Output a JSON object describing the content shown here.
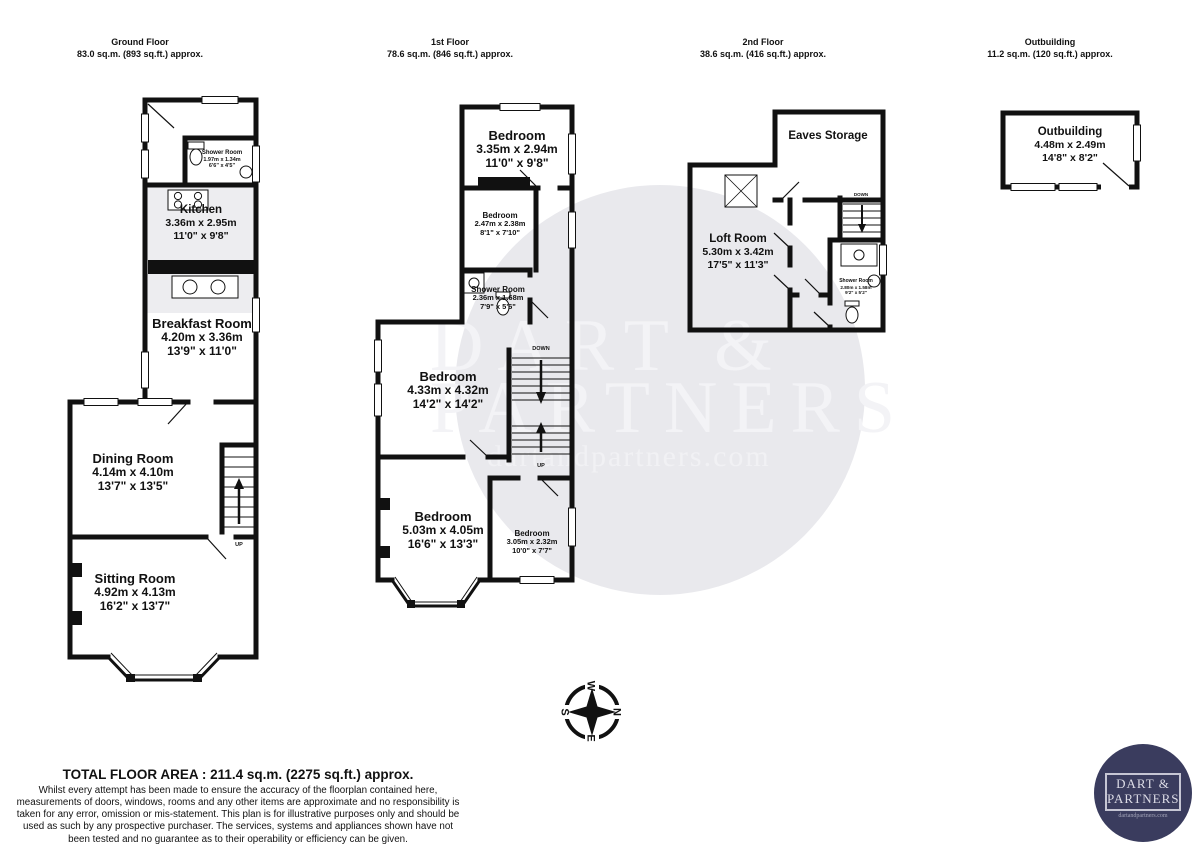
{
  "floors": [
    {
      "title": "Ground Floor",
      "area": "83.0 sq.m. (893 sq.ft.) approx.",
      "rooms": [
        {
          "name": "Shower Room",
          "metric": "1.97m  x 1.34m",
          "imperial": "6'6\"  x 4'5\""
        },
        {
          "name": "Kitchen",
          "metric": "3.36m  x 2.95m",
          "imperial": "11'0\"  x 9'8\""
        },
        {
          "name": "Breakfast Room",
          "metric": "4.20m  x 3.36m",
          "imperial": "13'9\"  x 11'0\""
        },
        {
          "name": "Dining Room",
          "metric": "4.14m  x 4.10m",
          "imperial": "13'7\"  x 13'5\""
        },
        {
          "name": "Sitting Room",
          "metric": "4.92m  x 4.13m",
          "imperial": "16'2\"  x 13'7\""
        }
      ],
      "stairs": [
        {
          "label": "UP"
        }
      ]
    },
    {
      "title": "1st Floor",
      "area": "78.6 sq.m. (846 sq.ft.) approx.",
      "rooms": [
        {
          "name": "Bedroom",
          "metric": "3.35m  x 2.94m",
          "imperial": "11'0\"  x 9'8\""
        },
        {
          "name": "Bedroom",
          "metric": "2.47m  x 2.38m",
          "imperial": "8'1\"  x 7'10\""
        },
        {
          "name": "Shower Room",
          "metric": "2.36m  x 1.68m",
          "imperial": "7'9\"  x 5'6\""
        },
        {
          "name": "Bedroom",
          "metric": "4.33m  x 4.32m",
          "imperial": "14'2\"  x 14'2\""
        },
        {
          "name": "Bedroom",
          "metric": "5.03m  x 4.05m",
          "imperial": "16'6\"  x 13'3\""
        },
        {
          "name": "Bedroom",
          "metric": "3.05m  x 2.32m",
          "imperial": "10'0\"  x 7'7\""
        }
      ],
      "stairs": [
        {
          "label": "DOWN"
        },
        {
          "label": "UP"
        }
      ]
    },
    {
      "title": "2nd Floor",
      "area": "38.6 sq.m. (416 sq.ft.) approx.",
      "rooms": [
        {
          "name": "Eaves Storage",
          "metric": "",
          "imperial": ""
        },
        {
          "name": "Loft Room",
          "metric": "5.30m  x 3.42m",
          "imperial": "17'5\"  x 11'3\""
        },
        {
          "name": "Shower Room",
          "metric": "2.80m  x 1.58m",
          "imperial": "9'2\"  x 5'2\""
        }
      ],
      "stairs": [
        {
          "label": "DOWN"
        }
      ]
    },
    {
      "title": "Outbuilding",
      "area": "11.2 sq.m. (120 sq.ft.) approx.",
      "rooms": [
        {
          "name": "Outbuilding",
          "metric": "4.48m  x 2.49m",
          "imperial": "14'8\"  x 8'2\""
        }
      ],
      "stairs": []
    }
  ],
  "watermark": {
    "line1": "DART &",
    "line2": "PARTNERS",
    "url": "dartandpartners.com"
  },
  "compass": {
    "n": "N",
    "e": "E",
    "s": "S",
    "w": "W"
  },
  "footer": {
    "total": "TOTAL FLOOR AREA : 211.4 sq.m. (2275 sq.ft.) approx.",
    "disclaimer": "Whilst every attempt has been made to ensure the accuracy of the floorplan contained here, measurements of doors, windows, rooms and any other items are approximate and no responsibility is taken for any error, omission or mis-statement. This plan is for illustrative purposes only and should be used as such by any prospective purchaser. The services, systems and appliances shown have not been tested and no guarantee as to their operability or efficiency can be given.",
    "credit": "Made with Metropix ©2024"
  },
  "logo": {
    "line1": "DART &",
    "line2": "PARTNERS",
    "url": "dartandpartners.com"
  },
  "colors": {
    "wall": "#111111",
    "watermark_circle": "#e9e9ed",
    "logo_bg": "#3a3c5e"
  }
}
